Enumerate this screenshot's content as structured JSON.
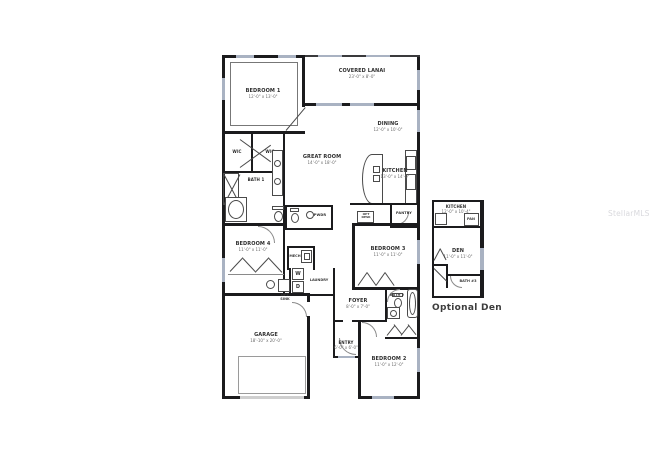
{
  "watermark": "StellarMLS",
  "inset_caption": "Optional Den",
  "labels": {
    "bedroom1": {
      "name": "BEDROOM 1",
      "dims": "12'-0\" x 13'-0\""
    },
    "lanai": {
      "name": "COVERED LANAI",
      "dims": "23'-0\" x 8'-0\""
    },
    "dining": {
      "name": "DINING",
      "dims": "12'-0\" x 10'-0\""
    },
    "great_room": {
      "name": "GREAT ROOM",
      "dims": "14'-0\" x 18'-0\""
    },
    "kitchen": {
      "name": "KITCHEN",
      "dims": "13'-0\" x 14'-0\""
    },
    "pantry": {
      "name": "PANTRY"
    },
    "pwdr": {
      "name": "PWDR"
    },
    "wic_left": {
      "name": "WIC"
    },
    "wic_right": {
      "name": "WIC"
    },
    "bath1": {
      "name": "BATH 1"
    },
    "bedroom4": {
      "name": "BEDROOM 4",
      "dims": "11'-0\" x 11'-0\""
    },
    "mech": {
      "name": "MECH"
    },
    "laundry": {
      "name": "LAUNDRY"
    },
    "washer": "W",
    "dryer": "D",
    "opt_sink": {
      "name": "OPT SINK"
    },
    "opt_desk": {
      "name": "OPT DESK"
    },
    "bedroom3": {
      "name": "BEDROOM 3",
      "dims": "11'-0\" x 11'-0\""
    },
    "foyer": {
      "name": "FOYER",
      "dims": "8'-0\" x 7'-0\""
    },
    "entry": {
      "name": "ENTRY",
      "dims": "6'-0\" x 6'-0\""
    },
    "garage": {
      "name": "GARAGE",
      "dims": "18'-10\" x 20'-0\""
    },
    "bath2": {
      "name": "BATH 2"
    },
    "bedroom2": {
      "name": "BEDROOM 2",
      "dims": "11'-0\" x 12'-0\""
    },
    "inset_kitchen": {
      "name": "KITCHEN",
      "dims": "12'-0\" x 10'-4\""
    },
    "pan": {
      "name": "PAN"
    },
    "den": {
      "name": "DEN",
      "dims": "11'-0\" x 11'-0\""
    },
    "bath3": {
      "name": "BATH #3"
    }
  },
  "colors": {
    "wall": "#1b1b1d",
    "window": "#a9b2c2",
    "watermark_text": "#d9d9dd"
  }
}
